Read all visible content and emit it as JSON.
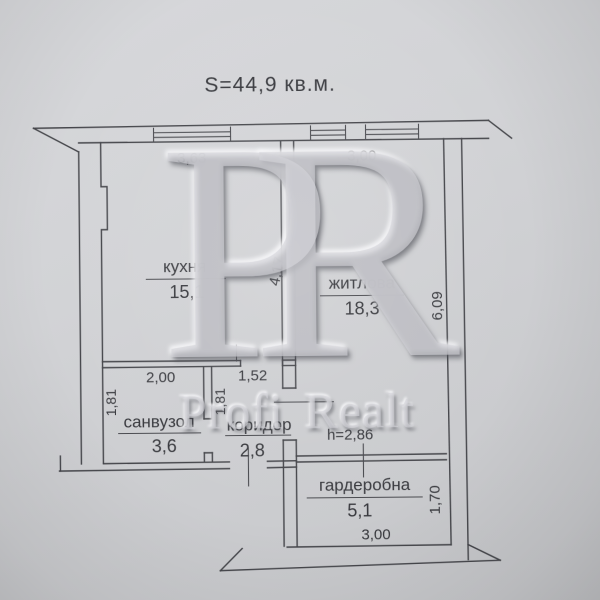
{
  "title": "S=44,9 кв.м.",
  "watermark": {
    "monogram": "PR",
    "brand": "Profi Realt"
  },
  "rooms": [
    {
      "name": "кухня",
      "area": "15,1"
    },
    {
      "name": "житлова",
      "area": "18,3"
    },
    {
      "name": "санвузол",
      "area": "3,6"
    },
    {
      "name": "коридор",
      "area": "2,8"
    },
    {
      "name": "гардеробна",
      "area": "5,1"
    }
  ],
  "dimensions": {
    "kitchen_width": "3,63",
    "living_width": "3,00",
    "kitchen_depth": "4,17",
    "living_depth": "6,09",
    "bathroom_width": "2,00",
    "hallway_width": "1,52",
    "bathroom_depth": "1,81",
    "hallway_depth": "1,81",
    "ceiling_height": "h=2,86",
    "wardrobe_depth": "1,70",
    "wardrobe_width": "3,00"
  }
}
